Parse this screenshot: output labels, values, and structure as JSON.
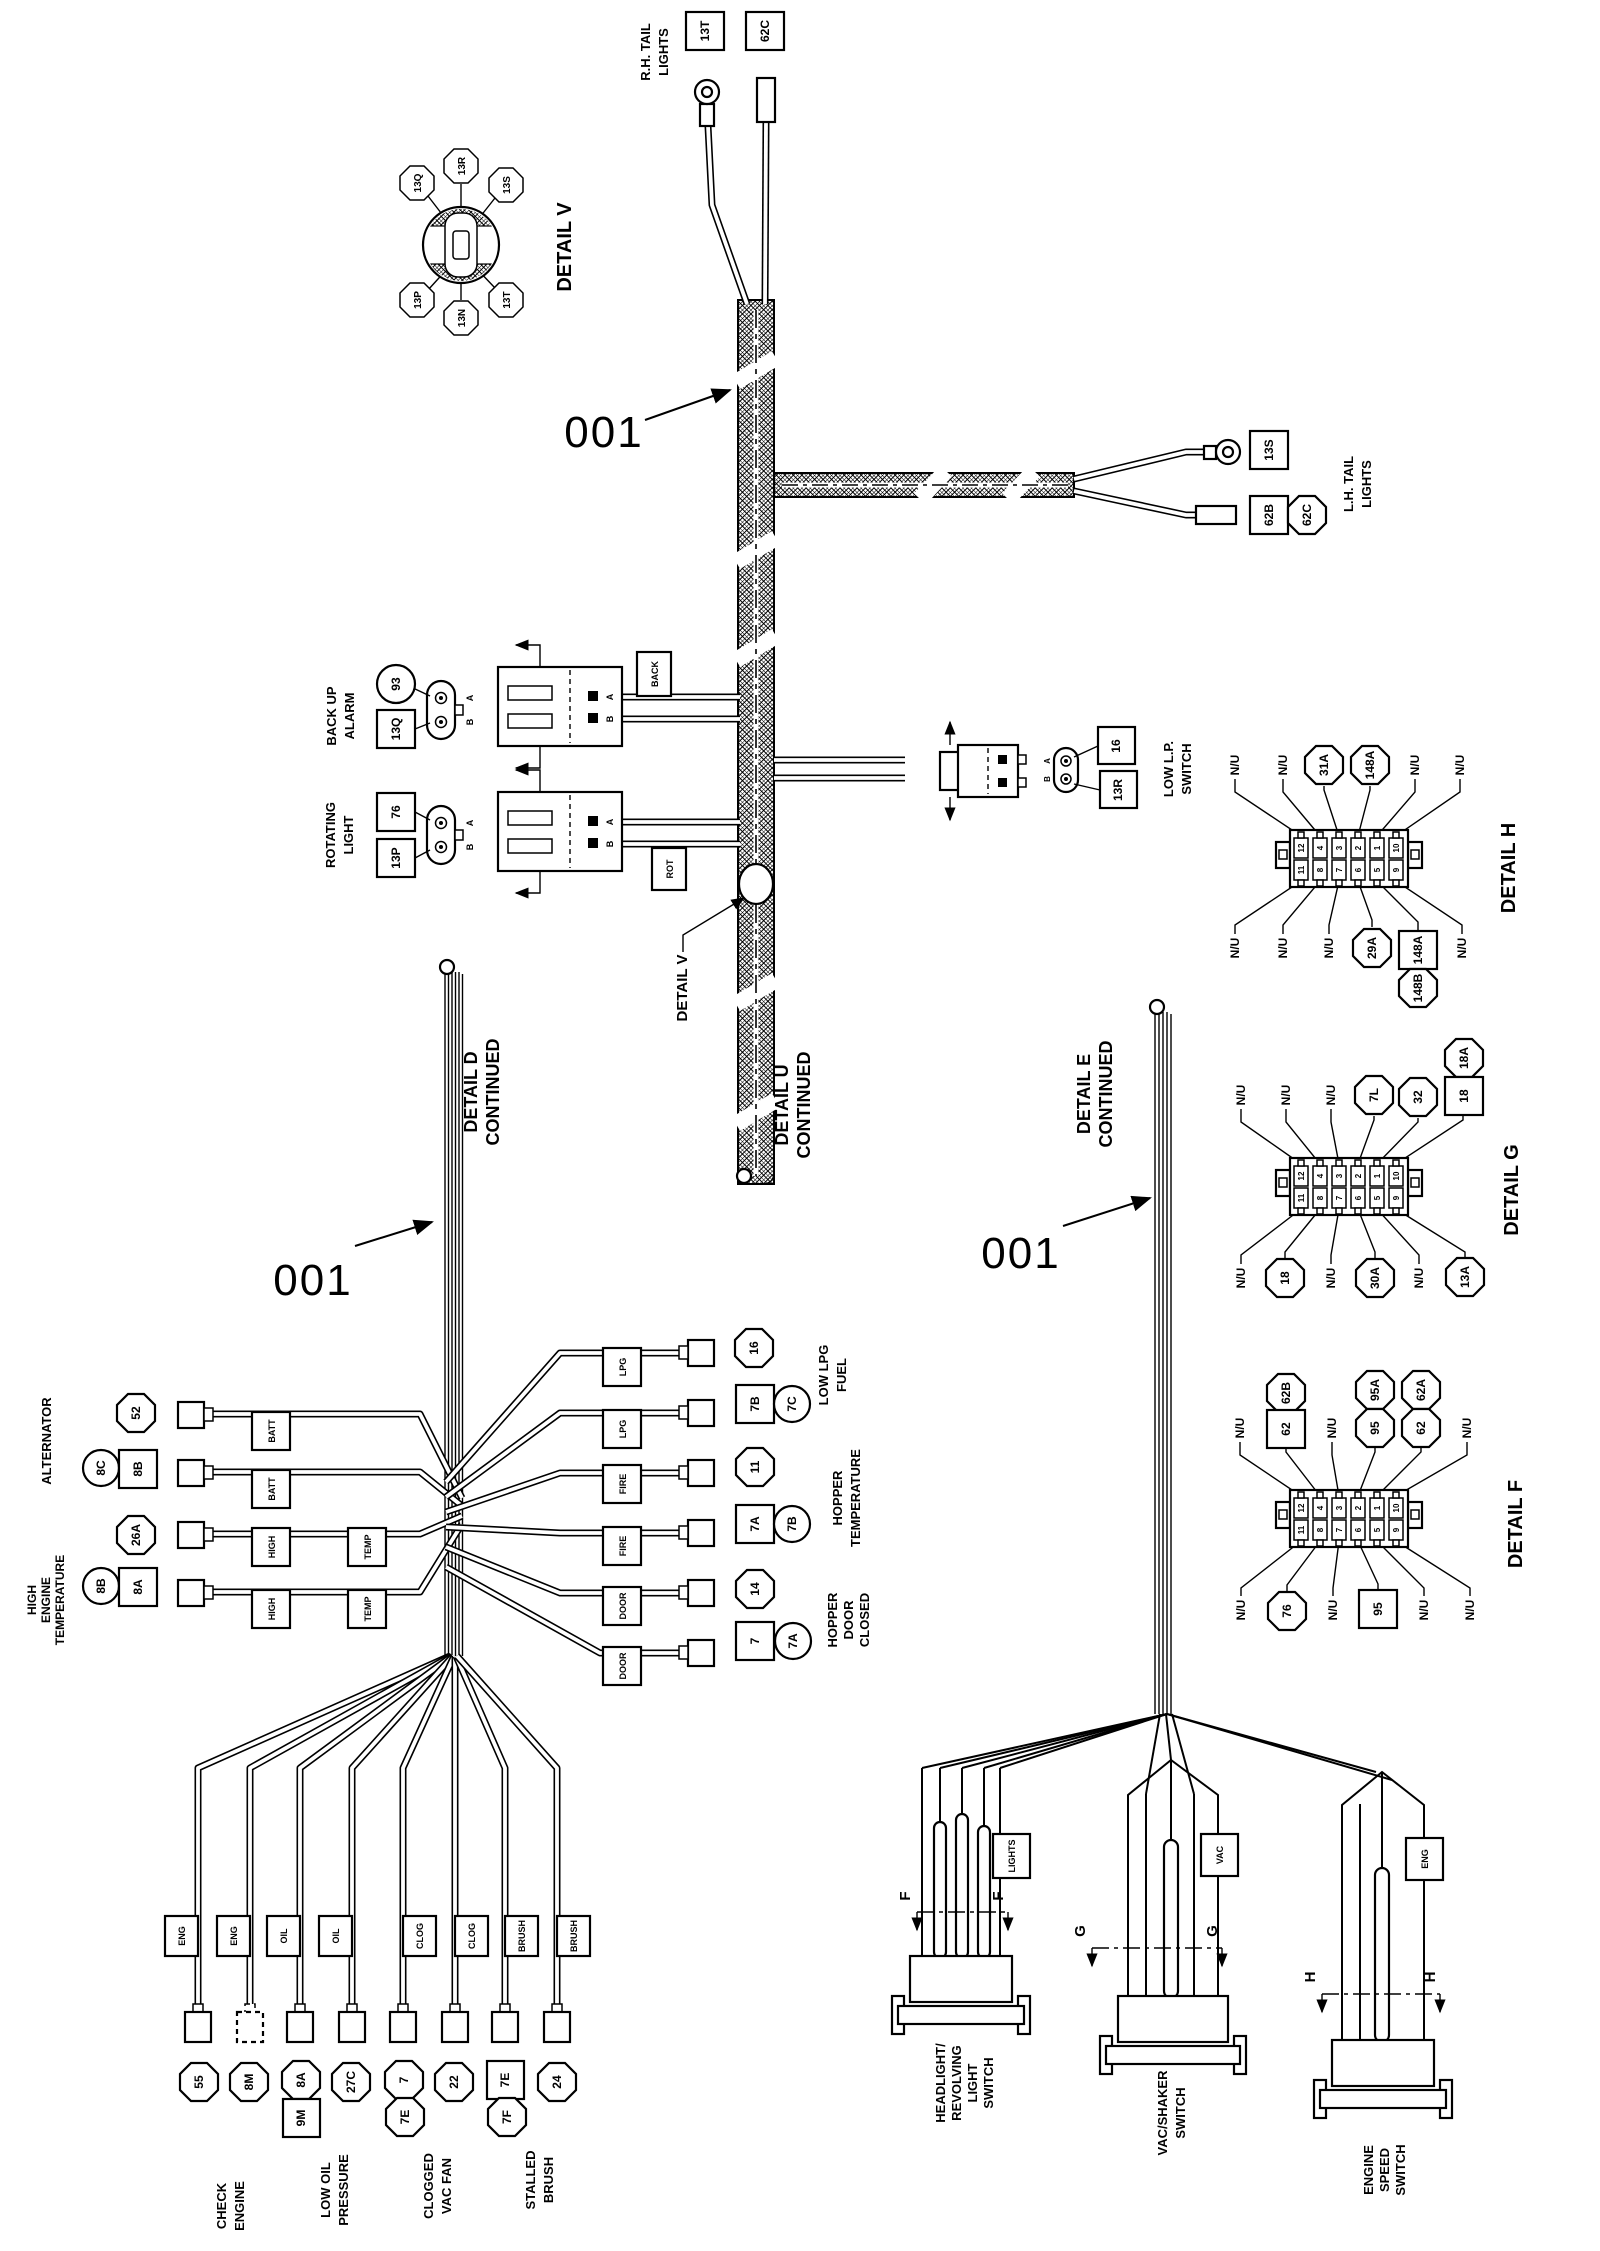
{
  "callout_001": "001",
  "rh_tail": {
    "cap1": "R.H. TAIL",
    "cap2": "LIGHTS",
    "id_13t": "13T",
    "id_62c": "62C"
  },
  "detail_v_inset": {
    "caption": "DETAIL V",
    "p_13q": "13Q",
    "p_13r": "13R",
    "p_13s": "13S",
    "p_13p": "13P",
    "p_13n": "13N",
    "p_13t": "13T"
  },
  "lh_tail": {
    "cap1": "L.H. TAIL",
    "cap2": "LIGHTS",
    "id_13s": "13S",
    "id_62b": "62B",
    "id_62c": "62C"
  },
  "backup_alarm": {
    "cap1": "BACK UP",
    "cap2": "ALARM",
    "id_93": "93",
    "id_13q": "13Q",
    "pin_a": "A",
    "pin_b": "B",
    "wire_tag": "BACK"
  },
  "rotating_light": {
    "cap1": "ROTATING",
    "cap2": "LIGHT",
    "id_76": "76",
    "id_13p": "13P",
    "pin_a": "A",
    "pin_b": "B",
    "wire_tag": "ROT"
  },
  "low_lp": {
    "cap1": "LOW L.P.",
    "cap2": "SWITCH",
    "id_16": "16",
    "id_13r": "13R",
    "pin_a": "A",
    "pin_b": "B"
  },
  "detail_v_callout": "DETAIL V",
  "detail_u": {
    "cap1": "DETAIL U",
    "cap2": "CONTINUED"
  },
  "detail_d": {
    "cap1": "DETAIL D",
    "cap2": "CONTINUED"
  },
  "detail_e": {
    "cap1": "DETAIL E",
    "cap2": "CONTINUED"
  },
  "alternator": {
    "caption": "ALTERNATOR",
    "id_52": "52",
    "id_8c": "8C",
    "id_8b": "8B"
  },
  "high_temp": {
    "cap1": "HIGH",
    "cap2": "ENGINE",
    "cap3": "TEMPERATURE",
    "id_26a": "26A",
    "id_8b": "8B",
    "id_8a": "8A"
  },
  "wire_tags_left": [
    "BATT",
    "BATT",
    "HIGH",
    "TEMP",
    "HIGH",
    "TEMP"
  ],
  "wire_tags_right": [
    "LPG",
    "LPG",
    "FIRE",
    "FIRE",
    "DOOR",
    "DOOR"
  ],
  "hopper": {
    "id_16": "16",
    "id_7b_box": "7B",
    "id_7c": "7C",
    "id_11": "11",
    "id_7a_box": "7A",
    "id_7b_circ": "7B",
    "id_14": "14",
    "id_7_box": "7",
    "id_7a_circ": "7A",
    "cap_fuel1": "LOW LPG",
    "cap_fuel2": "FUEL",
    "cap_temp1": "HOPPER",
    "cap_temp2": "TEMPERATURE",
    "cap_door1": "HOPPER",
    "cap_door2": "DOOR",
    "cap_door3": "CLOSED"
  },
  "bottom_left": {
    "wire_tags": [
      "ENG",
      "ENG",
      "OIL",
      "OIL",
      "CLOG",
      "CLOG",
      "BRUSH",
      "BRUSH"
    ],
    "id_55": "55",
    "id_8m": "8M",
    "id_8a": "8A",
    "id_9m": "9M",
    "id_27c": "27C",
    "id_7": "7",
    "id_7e_oct": "7E",
    "id_22": "22",
    "id_7e_box": "7E",
    "id_7f": "7F",
    "id_24": "24",
    "cap_check1": "CHECK",
    "cap_check2": "ENGINE",
    "cap_oil1": "LOW OIL",
    "cap_oil2": "PRESSURE",
    "cap_clog1": "CLOGGED",
    "cap_clog2": "VAC FAN",
    "cap_brush1": "STALLED",
    "cap_brush2": "BRUSH"
  },
  "switches": {
    "tag_lights": "LIGHTS",
    "tag_vac": "VAC",
    "tag_eng": "ENG",
    "sec_f": "F",
    "sec_g": "G",
    "sec_h": "H",
    "cap_head1": "HEADLIGHT/",
    "cap_head2": "REVOLVING",
    "cap_head3": "LIGHT",
    "cap_head4": "SWITCH",
    "cap_vac1": "VAC/SHAKER",
    "cap_vac2": "SWITCH",
    "cap_eng1": "ENGINE",
    "cap_eng2": "SPEED",
    "cap_eng3": "SWITCH"
  },
  "detail_h": {
    "caption": "DETAIL H",
    "top": [
      "N/U",
      "N/U",
      "31A",
      "148A",
      "N/U",
      "N/U"
    ],
    "bottom": [
      "N/U",
      "N/U",
      "N/U",
      "29A",
      "148A",
      "N/U"
    ],
    "extra": "148B",
    "pins_top": [
      "12",
      "4",
      "3",
      "2",
      "1",
      "10"
    ],
    "pins_bottom": [
      "11",
      "8",
      "7",
      "6",
      "5",
      "9"
    ]
  },
  "detail_g": {
    "caption": "DETAIL G",
    "top": [
      "N/U",
      "N/U",
      "N/U",
      "7L",
      "32",
      "18"
    ],
    "extra": "18A",
    "bottom": [
      "N/U",
      "18",
      "N/U",
      "30A",
      "N/U",
      "13A"
    ],
    "pins_top": [
      "12",
      "4",
      "3",
      "2",
      "1",
      "10"
    ],
    "pins_bottom": [
      "11",
      "8",
      "7",
      "6",
      "5",
      "9"
    ]
  },
  "detail_f": {
    "caption": "DETAIL F",
    "top": [
      "N/U",
      "62",
      "N/U",
      "95",
      "62",
      "N/U"
    ],
    "extra_62b": "62B",
    "extra_95a": "95A",
    "extra_62a": "62A",
    "bottom": [
      "N/U",
      "76",
      "N/U",
      "95",
      "N/U",
      "N/U"
    ],
    "pins_top": [
      "12",
      "4",
      "3",
      "2",
      "1",
      "10"
    ],
    "pins_bottom": [
      "11",
      "8",
      "7",
      "6",
      "5",
      "9"
    ]
  }
}
